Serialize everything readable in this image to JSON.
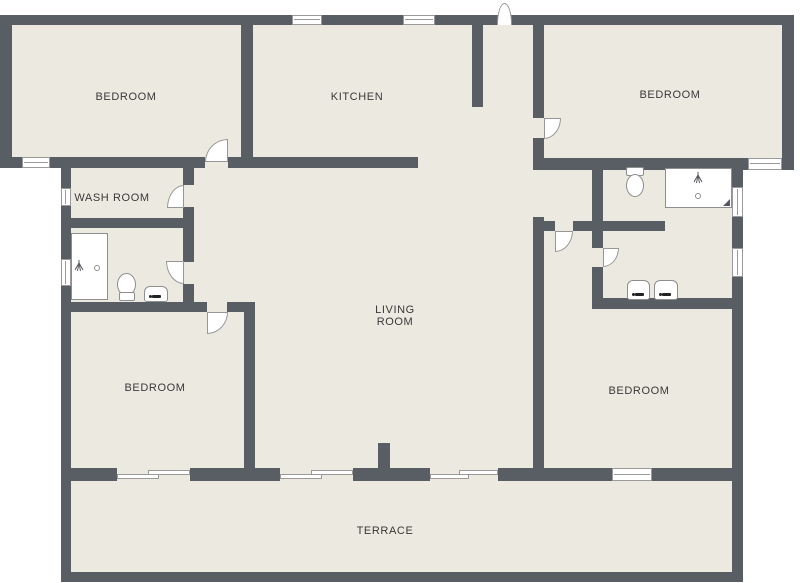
{
  "plan": {
    "type": "residential floor plan",
    "rooms": {
      "bedroom_top_left": {
        "label": "BEDROOM"
      },
      "kitchen": {
        "label": "KITCHEN"
      },
      "bedroom_top_right": {
        "label": "BEDROOM"
      },
      "wash_room": {
        "label": "WASH ROOM"
      },
      "living_room": {
        "label": "LIVING ROOM"
      },
      "bedroom_bottom_left": {
        "label": "BEDROOM"
      },
      "bedroom_bottom_right": {
        "label": "BEDROOM"
      },
      "terrace": {
        "label": "TERRACE"
      }
    },
    "colors": {
      "wall": "#595e65",
      "floor": "#eceae0",
      "background": "#ffffff",
      "fixture_outline": "#8e8e8e",
      "label_text": "#383838"
    },
    "fixtures": {
      "left_bathroom": [
        "shower-tub",
        "toilet",
        "sink"
      ],
      "right_bathroom": [
        "toilet",
        "shower",
        "sink",
        "sink"
      ]
    },
    "openings": {
      "exterior_doors": 1,
      "interior_doors": 7,
      "windows": 9,
      "sliding_doors": 3
    }
  }
}
